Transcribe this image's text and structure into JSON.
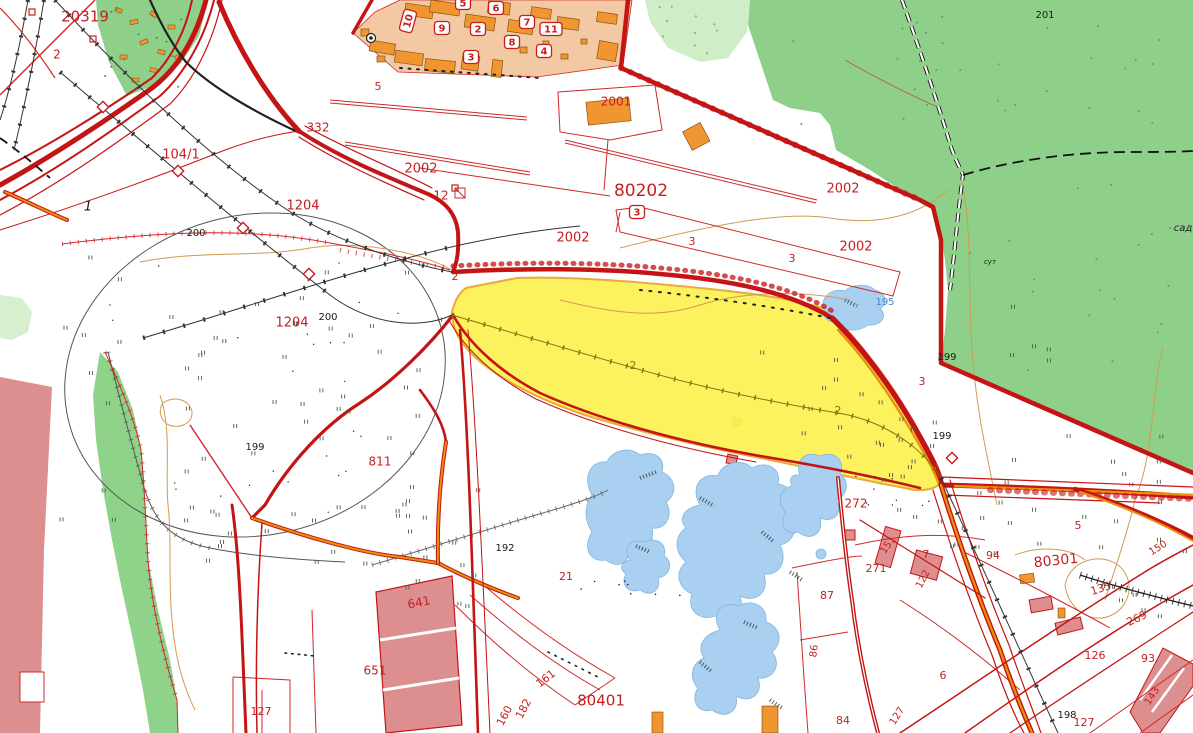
{
  "map": {
    "type": "cadastral-topographic-map",
    "colors": {
      "forest": "#8ed08a",
      "forest_pale": "#cfeec8",
      "green_band": "#8fd38b",
      "water": "#a9cff1",
      "water_edge": "#85b5de",
      "built_up_tan": "#f2c9a2",
      "building_orange": "#f0952f",
      "industrial_pink": "#dd8f8f",
      "selected_yellow": "#fbf14f",
      "selection_border": "#e9aa3d",
      "road_red": "#c41414",
      "road_orange": "#e8920c",
      "parcel_red": "#d02828",
      "contour_orange": "#d49a52",
      "rail_black": "#222222",
      "label_red": "#c52020",
      "label_black": "#1a1a1a",
      "label_blue": "#3b87d0",
      "label_olive": "#7a7a10"
    },
    "labels": [
      {
        "t": "20319",
        "x": 85,
        "y": 17,
        "c": "red",
        "s": 15
      },
      {
        "t": "2",
        "x": 57,
        "y": 55,
        "c": "red",
        "s": 12
      },
      {
        "t": "104/1",
        "x": 181,
        "y": 155,
        "c": "red",
        "s": 13
      },
      {
        "t": "332",
        "x": 318,
        "y": 128,
        "c": "red",
        "s": 12
      },
      {
        "t": "1204",
        "x": 303,
        "y": 206,
        "c": "red",
        "s": 13
      },
      {
        "t": "2002",
        "x": 421,
        "y": 169,
        "c": "red",
        "s": 13
      },
      {
        "t": "12",
        "x": 441,
        "y": 196,
        "c": "red",
        "s": 12
      },
      {
        "t": "2002",
        "x": 573,
        "y": 238,
        "c": "red",
        "s": 13
      },
      {
        "t": "80202",
        "x": 641,
        "y": 191,
        "c": "red",
        "s": 17
      },
      {
        "t": "2001",
        "x": 616,
        "y": 102,
        "c": "red",
        "s": 12
      },
      {
        "t": "2002",
        "x": 843,
        "y": 189,
        "c": "red",
        "s": 13
      },
      {
        "t": "2002",
        "x": 856,
        "y": 247,
        "c": "red",
        "s": 13
      },
      {
        "t": "3",
        "x": 692,
        "y": 242,
        "c": "red",
        "s": 11
      },
      {
        "t": "3",
        "x": 792,
        "y": 259,
        "c": "red",
        "s": 11
      },
      {
        "t": "2",
        "x": 455,
        "y": 277,
        "c": "red",
        "s": 11
      },
      {
        "t": "1204",
        "x": 292,
        "y": 323,
        "c": "red",
        "s": 13
      },
      {
        "t": "811",
        "x": 380,
        "y": 462,
        "c": "red",
        "s": 12
      },
      {
        "t": "3",
        "x": 922,
        "y": 382,
        "c": "red",
        "s": 11
      },
      {
        "t": "272",
        "x": 856,
        "y": 504,
        "c": "red",
        "s": 12
      },
      {
        "t": "21",
        "x": 566,
        "y": 577,
        "c": "red",
        "s": 11
      },
      {
        "t": "641",
        "x": 419,
        "y": 603,
        "c": "red",
        "s": 12,
        "r": -12
      },
      {
        "t": "161",
        "x": 546,
        "y": 679,
        "c": "red",
        "s": 11,
        "r": -38
      },
      {
        "t": "160",
        "x": 505,
        "y": 716,
        "c": "red",
        "s": 11,
        "r": -62
      },
      {
        "t": "182",
        "x": 524,
        "y": 709,
        "c": "red",
        "s": 11,
        "r": -62
      },
      {
        "t": "80401",
        "x": 601,
        "y": 701,
        "c": "red",
        "s": 15
      },
      {
        "t": "651",
        "x": 375,
        "y": 671,
        "c": "red",
        "s": 12
      },
      {
        "t": "127",
        "x": 261,
        "y": 712,
        "c": "red",
        "s": 11
      },
      {
        "t": "127",
        "x": 897,
        "y": 716,
        "c": "red",
        "s": 10,
        "r": -58
      },
      {
        "t": "84",
        "x": 843,
        "y": 721,
        "c": "red",
        "s": 11
      },
      {
        "t": "86",
        "x": 814,
        "y": 651,
        "c": "red",
        "s": 10,
        "r": -82
      },
      {
        "t": "87",
        "x": 827,
        "y": 596,
        "c": "red",
        "s": 11
      },
      {
        "t": "271",
        "x": 876,
        "y": 569,
        "c": "red",
        "s": 11
      },
      {
        "t": "151",
        "x": 888,
        "y": 545,
        "c": "red",
        "s": 10,
        "r": -55
      },
      {
        "t": "122",
        "x": 923,
        "y": 579,
        "c": "red",
        "s": 10,
        "r": -62
      },
      {
        "t": "7",
        "x": 926,
        "y": 555,
        "c": "red",
        "s": 11
      },
      {
        "t": "6",
        "x": 943,
        "y": 676,
        "c": "red",
        "s": 11
      },
      {
        "t": "94",
        "x": 993,
        "y": 556,
        "c": "red",
        "s": 11
      },
      {
        "t": "80301",
        "x": 1056,
        "y": 561,
        "c": "red",
        "s": 14,
        "r": -6
      },
      {
        "t": "5",
        "x": 1078,
        "y": 526,
        "c": "red",
        "s": 11
      },
      {
        "t": "150",
        "x": 1158,
        "y": 548,
        "c": "red",
        "s": 10,
        "r": -32
      },
      {
        "t": "135",
        "x": 1101,
        "y": 589,
        "c": "red",
        "s": 11,
        "r": -18
      },
      {
        "t": "269",
        "x": 1137,
        "y": 619,
        "c": "red",
        "s": 11,
        "r": -25
      },
      {
        "t": "126",
        "x": 1095,
        "y": 656,
        "c": "red",
        "s": 11
      },
      {
        "t": "93",
        "x": 1148,
        "y": 659,
        "c": "red",
        "s": 11
      },
      {
        "t": "143",
        "x": 1152,
        "y": 696,
        "c": "red",
        "s": 10,
        "r": -58
      },
      {
        "t": "127",
        "x": 1084,
        "y": 723,
        "c": "red",
        "s": 11
      },
      {
        "t": "5",
        "x": 378,
        "y": 87,
        "c": "red",
        "s": 11
      },
      {
        "t": "200",
        "x": 196,
        "y": 233,
        "c": "black",
        "s": 10
      },
      {
        "t": "200",
        "x": 328,
        "y": 317,
        "c": "black",
        "s": 10
      },
      {
        "t": "201",
        "x": 1045,
        "y": 15,
        "c": "black",
        "s": 10
      },
      {
        "t": "199",
        "x": 255,
        "y": 447,
        "c": "black",
        "s": 10
      },
      {
        "t": "199",
        "x": 947,
        "y": 357,
        "c": "black",
        "s": 10
      },
      {
        "t": "199",
        "x": 942,
        "y": 436,
        "c": "black",
        "s": 10
      },
      {
        "t": "192",
        "x": 505,
        "y": 548,
        "c": "black",
        "s": 10
      },
      {
        "t": "198",
        "x": 1067,
        "y": 715,
        "c": "black",
        "s": 10
      },
      {
        "t": "1",
        "x": 88,
        "y": 207,
        "c": "black",
        "s": 13,
        "i": true
      },
      {
        "t": "195",
        "x": 885,
        "y": 302,
        "c": "blue",
        "s": 10
      },
      {
        "t": "2",
        "x": 633,
        "y": 366,
        "c": "olive",
        "s": 11
      },
      {
        "t": "2",
        "x": 838,
        "y": 411,
        "c": "olive",
        "s": 11
      },
      {
        "t": "сут",
        "x": 990,
        "y": 262,
        "c": "black",
        "s": 7,
        "i": true
      },
      {
        "t": "сад",
        "x": 1183,
        "y": 228,
        "c": "black",
        "s": 10,
        "i": true
      }
    ],
    "building_badges": [
      {
        "t": "5",
        "x": 463,
        "y": 3
      },
      {
        "t": "6",
        "x": 496,
        "y": 8
      },
      {
        "t": "7",
        "x": 527,
        "y": 22
      },
      {
        "t": "11",
        "x": 551,
        "y": 29
      },
      {
        "t": "9",
        "x": 442,
        "y": 28
      },
      {
        "t": "2",
        "x": 478,
        "y": 29
      },
      {
        "t": "8",
        "x": 512,
        "y": 42
      },
      {
        "t": "4",
        "x": 544,
        "y": 51
      },
      {
        "t": "3",
        "x": 471,
        "y": 57
      },
      {
        "t": "10",
        "x": 408,
        "y": 21,
        "r": -75
      },
      {
        "t": "3",
        "x": 637,
        "y": 212
      }
    ],
    "symbols": {
      "boundary-diamond-icon": [
        [
          103,
          107
        ],
        [
          178,
          171
        ],
        [
          243,
          228
        ],
        [
          309,
          274
        ],
        [
          952,
          458
        ]
      ],
      "red-square-icon": [
        [
          32,
          12
        ],
        [
          93,
          39
        ],
        [
          455,
          188
        ]
      ],
      "well-icon": [
        371,
        38
      ]
    }
  }
}
